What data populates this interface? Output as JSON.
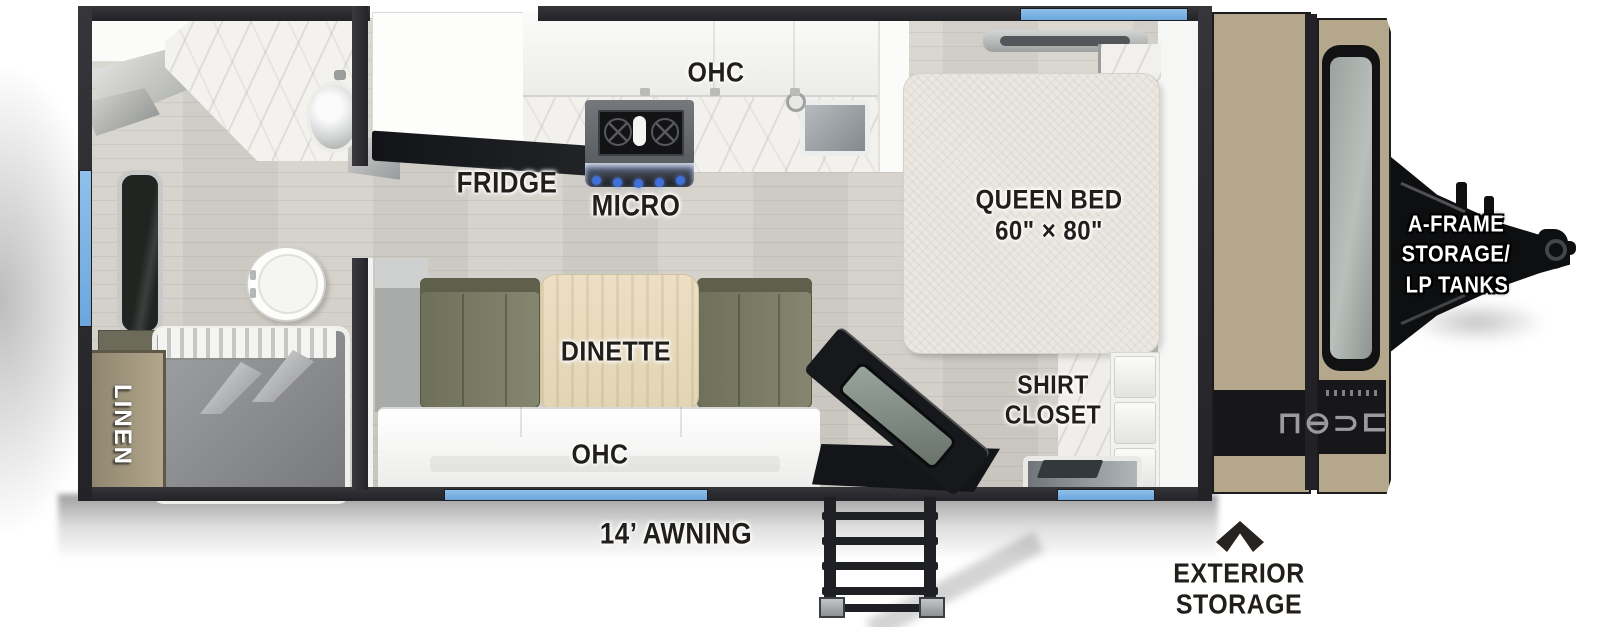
{
  "floorplan": {
    "bathroom": {
      "linen_label": "LINEN"
    },
    "kitchen": {
      "ohc_label": "OHC",
      "fridge_label": "FRIDGE",
      "micro_label": "MICRO"
    },
    "dinette": {
      "label": "DINETTE",
      "ohc_label": "OHC"
    },
    "bedroom": {
      "bed_label_line1": "QUEEN BED",
      "bed_label_line2": "60\" × 80\"",
      "closet_label_line1": "SHIRT",
      "closet_label_line2": "CLOSET"
    },
    "exterior": {
      "awning_label": "14’ AWNING",
      "storage_label_line1": "EXTERIOR",
      "storage_label_line2": "STORAGE",
      "aframe_label_line1": "A-FRAME",
      "aframe_label_line2": "STORAGE/",
      "aframe_label_line3": "LP TANKS",
      "logo_glyphs": "⊐⊂⊖⊔"
    }
  },
  "colors": {
    "wall_dark": "#29292e",
    "window_blue": "#78b1e2",
    "front_cap_tan": "#b5a78b",
    "bench_olive": "#7c7e68",
    "table_wood": "#e7dcc1",
    "label_dark": "#221f1b",
    "label_white": "#ffffff",
    "floor_gray": "#d4d1ca"
  }
}
